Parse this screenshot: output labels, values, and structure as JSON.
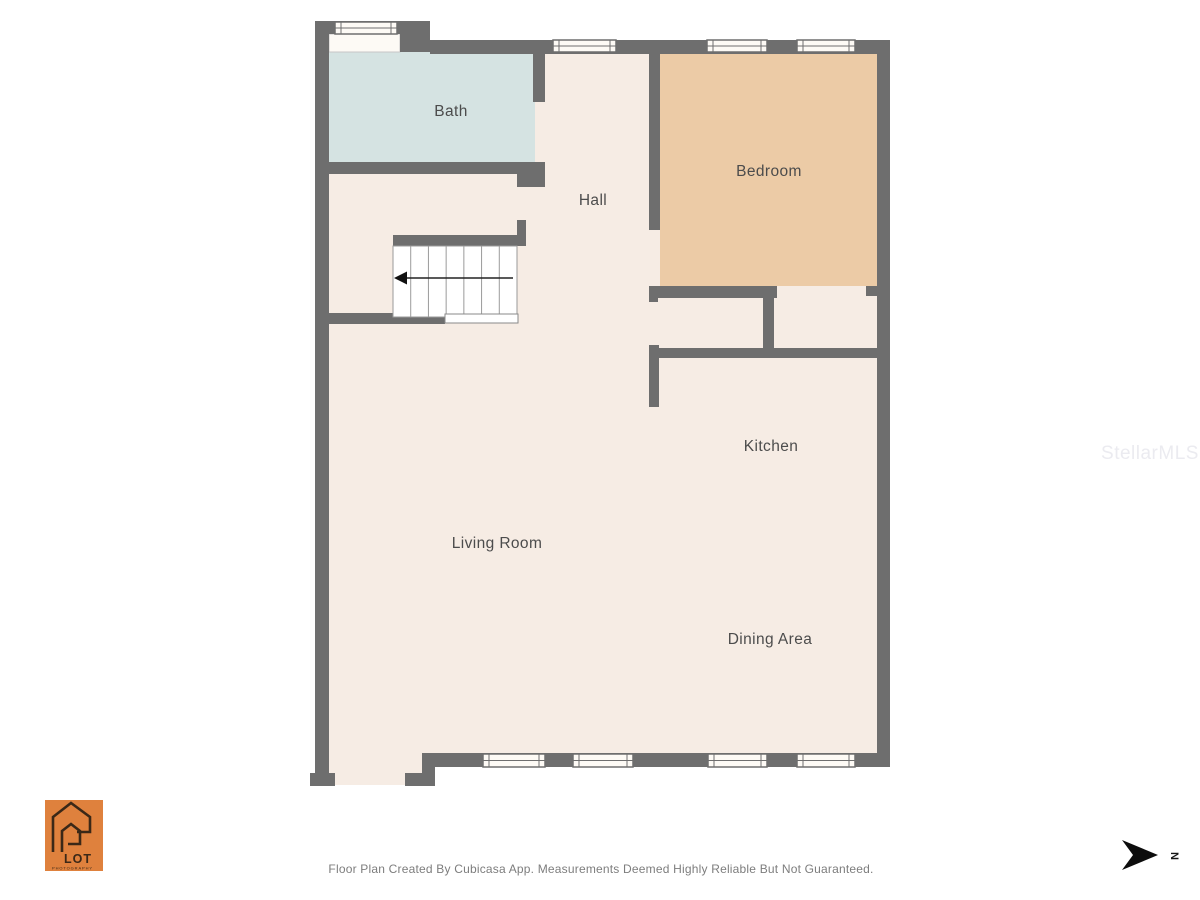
{
  "colors": {
    "wall": "#6e6e6e",
    "floor": "#f6ece4",
    "bath": "#d5e3e2",
    "bedroom": "#eccba6",
    "stair_fill": "#ffffff",
    "window_fill": "#fdfaf5",
    "label_text": "#4c4c4c",
    "caption_text": "#7d7d7d",
    "watermark": "#ebebf0",
    "logo_orange": "#df813d",
    "logo_dark": "#3b2817",
    "compass": "#0d0d0d"
  },
  "rooms": {
    "bath": {
      "label": "Bath"
    },
    "hall": {
      "label": "Hall"
    },
    "bedroom": {
      "label": "Bedroom"
    },
    "kitchen": {
      "label": "Kitchen"
    },
    "living_room": {
      "label": "Living Room"
    },
    "dining_area": {
      "label": "Dining Area"
    }
  },
  "stairs": {
    "treads": 7,
    "arrow_direction": "left"
  },
  "footer": {
    "disclaimer": "Floor Plan Created By Cubicasa App. Measurements Deemed Highly Reliable But Not Guaranteed."
  },
  "watermark": {
    "text": "StellarMLS"
  },
  "logo": {
    "line1": "LOT",
    "line2": "PHOTOGRAPHY"
  },
  "compass": {
    "label": "N"
  }
}
